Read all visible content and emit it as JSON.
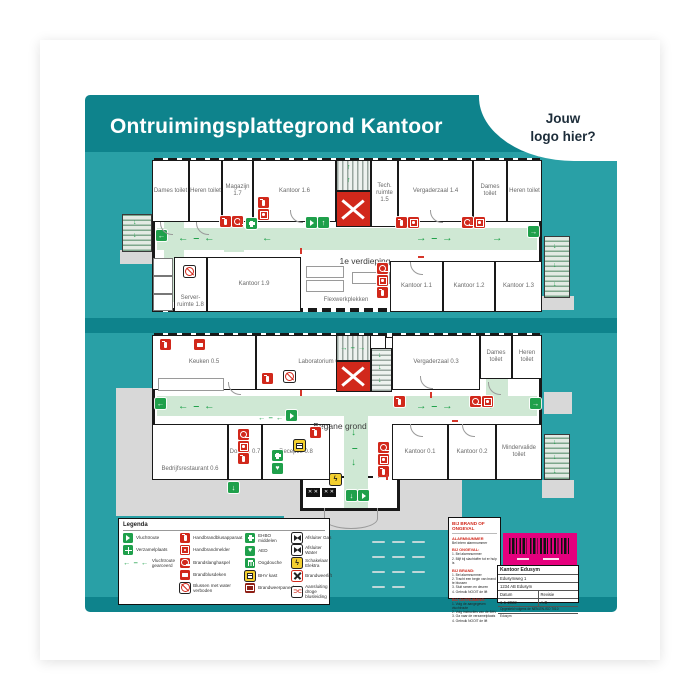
{
  "title": "Ontruimingsplattegrond Kantoor",
  "logo": {
    "line1": "Jouw",
    "line2": "logo hier?"
  },
  "floors": {
    "floor1": {
      "label": "1e verdieping",
      "rooms": {
        "dames": "Dames toilet",
        "heren": "Heren toilet",
        "magazijn": "Magazijn 1.7",
        "kantoor16": "Kantoor 1.6",
        "tech": "Tech. ruimte 1.5",
        "vergaderzaal": "Vergaderzaal 1.4",
        "dames2": "Dames toilet",
        "heren2": "Heren toilet",
        "server": "Server- ruimte 1.8",
        "kantoor19": "Kantoor 1.9",
        "flex": "Flexwerkplekken",
        "kantoor11": "Kantoor 1.1",
        "kantoor12": "Kantoor 1.2",
        "kantoor13": "Kantoor 1.3"
      }
    },
    "floor0": {
      "label": "Begane grond",
      "rooms": {
        "keuken": "Keuken 0.5",
        "lab": "Laboratorium 0.4",
        "vergaderzaal": "Vergaderzaal 0.3",
        "dames": "Dames toilet",
        "heren": "Heren toilet",
        "restaurant": "Bedrijfsrestaurant 0.6",
        "douche": "Douche 0.7",
        "receptie": "Receptie 0.8",
        "kantoor01": "Kantoor 0.1",
        "kantoor02": "Kantoor 0.2",
        "mindervalide": "Mindervalide toilet"
      }
    }
  },
  "icons": {
    "arrow_left": "←",
    "arrow_right": "→",
    "arrow_up": "↑",
    "arrow_down": "↓",
    "route_left": "← – ←",
    "route_right": "→ – →",
    "dash": "–",
    "droge_leiding": "⊃⊂",
    "bolt": "ϟ",
    "cross_small": "✕"
  },
  "legend": {
    "title": "Legenda",
    "col1": [
      "Vluchtroute",
      "Verzamelplaats",
      "Vluchtroute gearceerd"
    ],
    "col2": [
      "Handbrandblusapparaat",
      "Handbrandmelder",
      "Brandslanghaspel",
      "Brandblusdeken",
      "Blussen met water verboden"
    ],
    "col3": [
      "EHBO middelen",
      "AED",
      "Oogdouche",
      "BHV kast",
      "Brandweerpaneel"
    ],
    "col4": [
      "Afsluiter Gas",
      "Afsluiter Water",
      "Schakelaar Elektra",
      "Brandweerlift",
      "Aansluiting droge blusleiding"
    ]
  },
  "emergency": {
    "header": "BIJ BRAND OF ONGEVAL",
    "alarm_title": "ALARMNUMMER",
    "alarm_text": "Bel intern alarmnummer",
    "sections": [
      {
        "title": "BIJ ONGEVAL:",
        "items": [
          "1. Bel alarmnummer",
          "2. Blijf bij slachtoffer tot er hulp is"
        ]
      },
      {
        "title": "BIJ BRAND:",
        "items": [
          "1. Bel alarmnummer",
          "2. Tracht een begin van brand te blussen",
          "3. Sluit ramen en deuren",
          "4. Gebruik NOOIT de lift"
        ]
      },
      {
        "title": "BIJ ONTRUIMING:",
        "items": [
          "1. Volg de aangegeven vluchtroute",
          "2. Volg instructies van de BHV",
          "3. Ga naar de verzamelplaats",
          "4. Gebruik NOOIT de lift"
        ]
      }
    ]
  },
  "info": {
    "company": "Kantoor Edusym",
    "address1": "Edusymweg 1",
    "address2": "1234 AB  Edusym",
    "datum_label": "Datum",
    "datum": "1-1-2022",
    "revisie_label": "Revisie",
    "revisie": "A.B",
    "note": "Opgesteld volgens de NEN-EN-ISO 7010",
    "footer": "Edusym"
  },
  "colors": {
    "teal": "#29a0a6",
    "teal_dark": "#0e838c",
    "red": "#d1281b",
    "green": "#1fa04b",
    "route_green": "#cfe8d4",
    "yellow": "#f3cf2f",
    "magenta": "#e5007d"
  }
}
